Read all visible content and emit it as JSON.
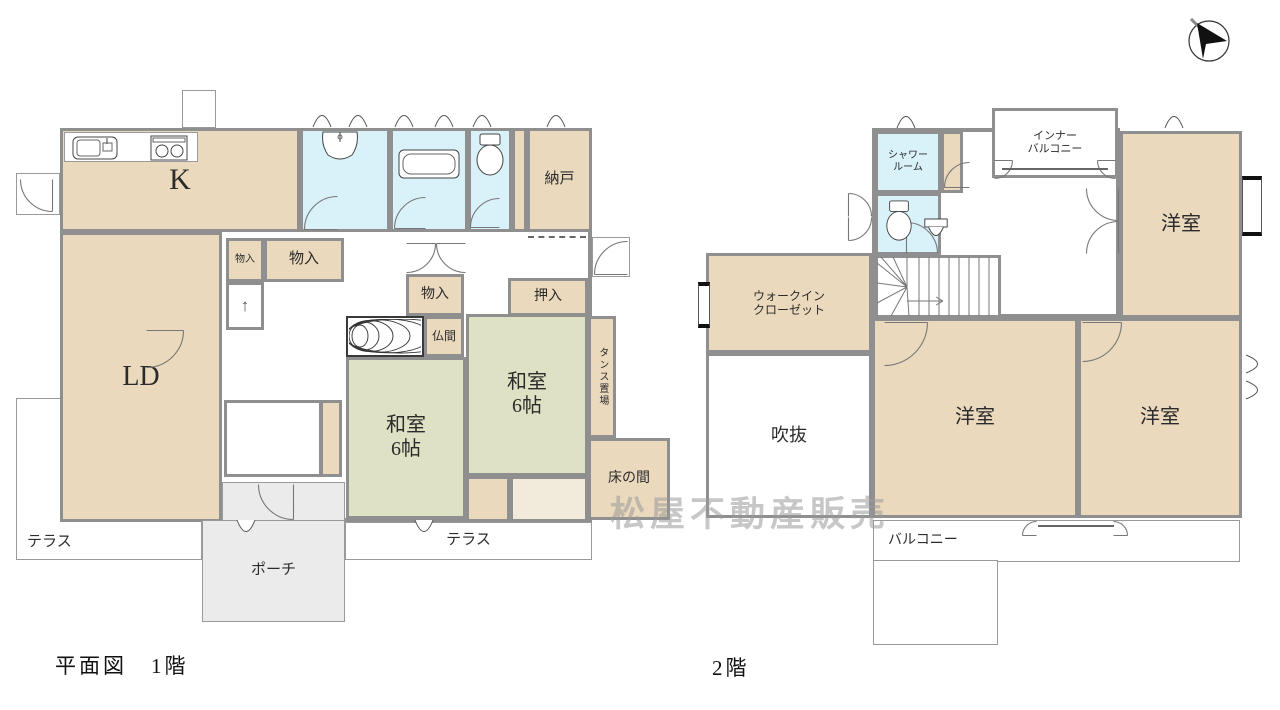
{
  "page": {
    "width": 1280,
    "height": 710,
    "bg": "#ffffff"
  },
  "colors": {
    "wall": "#8f8f8f",
    "tan": "#ead9bd",
    "tatami": "#dee1c3",
    "wet": "#d9f1f9",
    "porch": "#ebebeb",
    "white": "#ffffff",
    "cream": "#f2ebdb",
    "label": "#2b2b2b",
    "watermark_gray": "#9a9a9a",
    "bay_black": "#111111"
  },
  "watermark": {
    "text": "松屋不動産販売",
    "x": 610,
    "y": 486
  },
  "compass": {
    "name": "north-arrow",
    "x": 1182,
    "y": 12
  },
  "floors": [
    {
      "id": "floor-1",
      "title": "平面図　1階",
      "title_x": 55,
      "title_y": 650,
      "rooms": [
        {
          "name": "terrace-left",
          "label": "テラス",
          "x": 16,
          "y": 398,
          "w": 186,
          "h": 162,
          "fill": "white",
          "cls": "thin la-bl",
          "fs": 15
        },
        {
          "name": "terrace-right",
          "label": "テラス",
          "x": 345,
          "y": 522,
          "w": 247,
          "h": 38,
          "fill": "white",
          "cls": "thin",
          "fs": 15
        },
        {
          "name": "floor1-outer-wall",
          "label": "",
          "x": 60,
          "y": 128,
          "w": 532,
          "h": 394,
          "fill": "white",
          "cls": "thick"
        },
        {
          "name": "kitchen",
          "label": "K",
          "x": 60,
          "y": 128,
          "w": 240,
          "h": 104,
          "fill": "tan",
          "fs": 30
        },
        {
          "name": "kitchen-counter",
          "label": "",
          "x": 64,
          "y": 132,
          "w": 134,
          "h": 30,
          "fill": "white",
          "cls": "thin"
        },
        {
          "name": "washroom",
          "label": "",
          "x": 300,
          "y": 128,
          "w": 90,
          "h": 104,
          "fill": "wet"
        },
        {
          "name": "bathroom",
          "label": "",
          "x": 390,
          "y": 128,
          "w": 78,
          "h": 104,
          "fill": "wet"
        },
        {
          "name": "toilet-1f",
          "label": "",
          "x": 468,
          "y": 128,
          "w": 44,
          "h": 104,
          "fill": "wet"
        },
        {
          "name": "closet-strip",
          "label": "",
          "x": 512,
          "y": 128,
          "w": 15,
          "h": 104,
          "fill": "tan"
        },
        {
          "name": "nando",
          "label": "納戸",
          "x": 527,
          "y": 128,
          "w": 65,
          "h": 104,
          "fill": "tan",
          "fs": 15
        },
        {
          "name": "living-dining",
          "label": "LD",
          "x": 60,
          "y": 232,
          "w": 162,
          "h": 290,
          "fill": "tan",
          "fs": 28
        },
        {
          "name": "monoire-small",
          "label": "物入",
          "x": 226,
          "y": 238,
          "w": 38,
          "h": 44,
          "fill": "tan",
          "fs": 10
        },
        {
          "name": "monoire-mid",
          "label": "物入",
          "x": 264,
          "y": 238,
          "w": 80,
          "h": 44,
          "fill": "tan",
          "fs": 15
        },
        {
          "name": "stairs-1f",
          "label": "↑",
          "x": 226,
          "y": 282,
          "w": 38,
          "h": 48,
          "fill": "white",
          "cls": "treads",
          "fs": 17,
          "lc": "#555555"
        },
        {
          "name": "monoire-center",
          "label": "物入",
          "x": 406,
          "y": 274,
          "w": 58,
          "h": 42,
          "fill": "tan",
          "fs": 14
        },
        {
          "name": "itanoma-wood-floor",
          "label": "",
          "x": 346,
          "y": 316,
          "w": 78,
          "h": 41,
          "fill": "white",
          "cls": "darkb"
        },
        {
          "name": "butsuma",
          "label": "仏間",
          "x": 424,
          "y": 316,
          "w": 40,
          "h": 41,
          "fill": "tan",
          "fs": 12
        },
        {
          "name": "oshiire",
          "label": "押入",
          "x": 508,
          "y": 278,
          "w": 80,
          "h": 38,
          "fill": "tan",
          "fs": 14
        },
        {
          "name": "washitsu-left",
          "label": "和室\n6帖",
          "x": 346,
          "y": 357,
          "w": 120,
          "h": 162,
          "fill": "tatami",
          "cls": "tatami",
          "fs": 20
        },
        {
          "name": "washitsu-right",
          "label": "和室\n6帖",
          "x": 466,
          "y": 314,
          "w": 122,
          "h": 162,
          "fill": "tatami",
          "cls": "tatami",
          "fs": 20
        },
        {
          "name": "tansu-okiba",
          "label": "タンス置場",
          "x": 588,
          "y": 316,
          "w": 28,
          "h": 122,
          "fill": "tan",
          "cls": "vert",
          "fs": 10
        },
        {
          "name": "tokonoma",
          "label": "床の間",
          "x": 588,
          "y": 438,
          "w": 82,
          "h": 82,
          "fill": "tan",
          "fs": 14
        },
        {
          "name": "engawa",
          "label": "",
          "x": 510,
          "y": 476,
          "w": 78,
          "h": 46,
          "fill": "cream",
          "cls": "stripes"
        },
        {
          "name": "genkan-step",
          "label": "",
          "x": 466,
          "y": 476,
          "w": 44,
          "h": 46,
          "fill": "tan"
        },
        {
          "name": "genkan-tile",
          "label": "",
          "x": 224,
          "y": 400,
          "w": 98,
          "h": 77,
          "fill": "white",
          "cls": "gridbg"
        },
        {
          "name": "shoe-cabinet",
          "label": "",
          "x": 320,
          "y": 400,
          "w": 22,
          "h": 77,
          "fill": "tan"
        },
        {
          "name": "porch-upper",
          "label": "",
          "x": 222,
          "y": 482,
          "w": 123,
          "h": 40,
          "fill": "porch",
          "cls": "thin"
        },
        {
          "name": "porch",
          "label": "ポーチ",
          "x": 202,
          "y": 520,
          "w": 143,
          "h": 102,
          "fill": "porch",
          "cls": "thin",
          "fs": 15
        },
        {
          "name": "service-landing-west",
          "label": "",
          "x": 16,
          "y": 173,
          "w": 44,
          "h": 42,
          "fill": "white",
          "cls": "gridbg thin"
        },
        {
          "name": "service-landing-north",
          "label": "",
          "x": 182,
          "y": 90,
          "w": 34,
          "h": 38,
          "fill": "white",
          "cls": "gridbg thin"
        },
        {
          "name": "service-landing-east",
          "label": "",
          "x": 592,
          "y": 237,
          "w": 38,
          "h": 40,
          "fill": "white",
          "cls": "gridbg thin"
        }
      ],
      "fixtures": [
        {
          "t": "sink_k",
          "x": 72,
          "y": 136,
          "w": 46,
          "h": 24
        },
        {
          "t": "stove",
          "x": 150,
          "y": 135,
          "w": 38,
          "h": 26
        },
        {
          "t": "vanity",
          "x": 320,
          "y": 131,
          "w": 40,
          "h": 30
        },
        {
          "t": "tub",
          "x": 398,
          "y": 149,
          "w": 62,
          "h": 30
        },
        {
          "t": "toilet",
          "x": 474,
          "y": 133,
          "w": 32,
          "h": 44
        },
        {
          "t": "wood",
          "x": 349,
          "y": 319,
          "w": 72,
          "h": 35
        }
      ],
      "arcs": [
        {
          "x": 146,
          "y": 330,
          "r": 38,
          "rot": 0
        },
        {
          "x": 304,
          "y": 196,
          "r": 34,
          "rot": 180
        },
        {
          "x": 394,
          "y": 197,
          "r": 32,
          "rot": 180
        },
        {
          "x": 470,
          "y": 198,
          "r": 30,
          "rot": 180
        },
        {
          "x": 406,
          "y": 243,
          "r": 30,
          "rot": 0
        },
        {
          "x": 436,
          "y": 243,
          "r": 30,
          "rot": 0,
          "flip": true
        },
        {
          "x": 258,
          "y": 484,
          "r": 36,
          "rot": 90
        },
        {
          "x": 20,
          "y": 179,
          "r": 33,
          "rot": 90
        },
        {
          "x": 594,
          "y": 241,
          "r": 34,
          "rot": 180
        }
      ],
      "peaks": [
        {
          "x": 312,
          "y": 112
        },
        {
          "x": 348,
          "y": 112
        },
        {
          "x": 394,
          "y": 112
        },
        {
          "x": 434,
          "y": 112
        },
        {
          "x": 472,
          "y": 112
        },
        {
          "x": 546,
          "y": 112
        },
        {
          "x": 236,
          "y": 519,
          "rot": 180
        },
        {
          "x": 414,
          "y": 519,
          "rot": 180
        }
      ],
      "dashes": [
        {
          "x": 528,
          "y": 236,
          "w": 58
        }
      ],
      "lines": []
    },
    {
      "id": "floor-2",
      "title": "2階",
      "title_x": 712,
      "title_y": 652,
      "rooms": [
        {
          "name": "balcony",
          "label": "バルコニー",
          "x": 873,
          "y": 520,
          "w": 367,
          "h": 42,
          "fill": "white",
          "cls": "thin la-l",
          "fs": 14
        },
        {
          "name": "balcony-deep",
          "label": "",
          "x": 873,
          "y": 560,
          "w": 125,
          "h": 85,
          "fill": "white",
          "cls": "thin"
        },
        {
          "name": "floor2-hall-wall",
          "label": "",
          "x": 872,
          "y": 128,
          "w": 248,
          "h": 190,
          "fill": "white",
          "cls": "thick"
        },
        {
          "name": "shower-room",
          "label": "シャワー\nルーム",
          "x": 875,
          "y": 131,
          "w": 66,
          "h": 62,
          "fill": "wet",
          "fs": 10
        },
        {
          "name": "shower-closet-strip",
          "label": "",
          "x": 941,
          "y": 131,
          "w": 22,
          "h": 62,
          "fill": "tan"
        },
        {
          "name": "toilet-2f",
          "label": "",
          "x": 875,
          "y": 193,
          "w": 66,
          "h": 62,
          "fill": "wet"
        },
        {
          "name": "stairs-2f",
          "label": "",
          "x": 875,
          "y": 255,
          "w": 126,
          "h": 63,
          "fill": "white"
        },
        {
          "name": "inner-balcony",
          "label": "インナー\nバルコニー",
          "x": 992,
          "y": 108,
          "w": 126,
          "h": 70,
          "fill": "white",
          "fs": 11
        },
        {
          "name": "yoshitsu-northeast",
          "label": "洋室",
          "x": 1120,
          "y": 131,
          "w": 122,
          "h": 187,
          "fill": "tan",
          "fs": 20
        },
        {
          "name": "walk-in-closet",
          "label": "ウォークイン\nクローゼット",
          "x": 706,
          "y": 253,
          "w": 166,
          "h": 100,
          "fill": "tan",
          "fs": 12
        },
        {
          "name": "fukinuke-void",
          "label": "吹抜",
          "x": 706,
          "y": 353,
          "w": 166,
          "h": 165,
          "fill": "white",
          "fs": 18
        },
        {
          "name": "yoshitsu-center",
          "label": "洋室",
          "x": 872,
          "y": 318,
          "w": 206,
          "h": 200,
          "fill": "tan",
          "fs": 20
        },
        {
          "name": "yoshitsu-southeast",
          "label": "洋室",
          "x": 1078,
          "y": 318,
          "w": 164,
          "h": 200,
          "fill": "tan",
          "fs": 20
        },
        {
          "name": "bay-window-east",
          "label": "",
          "x": 1242,
          "y": 176,
          "w": 20,
          "h": 60,
          "fill": "white",
          "cls": "bayh"
        },
        {
          "name": "window-wic-west",
          "label": "",
          "x": 698,
          "y": 282,
          "w": 12,
          "h": 46,
          "fill": "white",
          "cls": "bayh"
        }
      ],
      "fixtures": [
        {
          "t": "toilet",
          "x": 884,
          "y": 200,
          "w": 30,
          "h": 42
        },
        {
          "t": "sink_s",
          "x": 922,
          "y": 218,
          "w": 28,
          "h": 24
        },
        {
          "t": "stairs2",
          "x": 877,
          "y": 257,
          "w": 122,
          "h": 59
        }
      ],
      "arcs": [
        {
          "x": 884,
          "y": 322,
          "r": 44,
          "rot": 0
        },
        {
          "x": 1082,
          "y": 322,
          "r": 40,
          "rot": 0
        },
        {
          "x": 1086,
          "y": 188,
          "r": 33,
          "rot": 90
        },
        {
          "x": 1086,
          "y": 221,
          "r": 33,
          "rot": 90,
          "flip": true
        },
        {
          "x": 944,
          "y": 162,
          "r": 26,
          "rot": 180
        },
        {
          "x": 906,
          "y": 222,
          "r": 32,
          "rot": 270
        },
        {
          "x": 848,
          "y": 193,
          "r": 24,
          "rot": 270
        },
        {
          "x": 848,
          "y": 217,
          "r": 24,
          "rot": 270,
          "flip": true
        },
        {
          "x": 1022,
          "y": 521,
          "r": 15,
          "rot": 180
        },
        {
          "x": 1113,
          "y": 521,
          "r": 15,
          "rot": 180,
          "flip": true
        },
        {
          "x": 994,
          "y": 160,
          "r": 19,
          "rot": 0
        },
        {
          "x": 1097,
          "y": 160,
          "r": 19,
          "rot": 0,
          "flip": true
        }
      ],
      "peaks": [
        {
          "x": 896,
          "y": 113
        },
        {
          "x": 1164,
          "y": 113
        },
        {
          "x": 1243,
          "y": 356,
          "rot": 90
        },
        {
          "x": 1243,
          "y": 382,
          "rot": 90
        }
      ],
      "dashes": [],
      "lines": [
        {
          "x": 1038,
          "y": 525,
          "w": 76
        },
        {
          "x": 1002,
          "y": 168,
          "w": 106
        }
      ]
    }
  ]
}
